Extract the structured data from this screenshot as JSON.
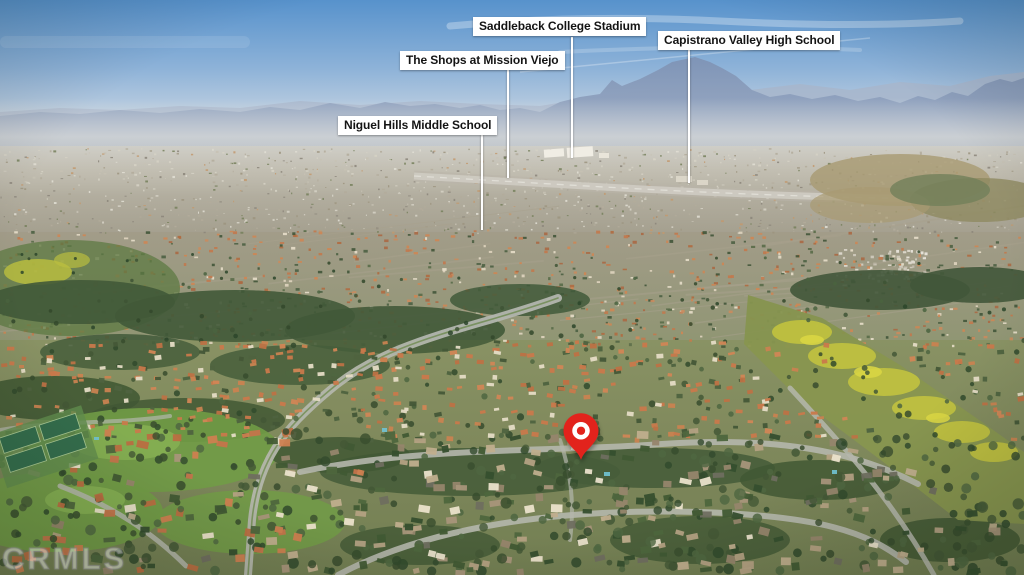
{
  "scene": {
    "type": "annotated aerial photograph",
    "description": "Aerial drone view over Spanish-tile-roof residential neighborhoods in a Southern California valley; hazy Saddleback mountain range on the horizon, a freeway corridor in the distance, greenbelts, a yellow wildflower hillside on the right and curving suburban streets in the foreground",
    "sky_color": "#5792cc",
    "mountain_color": "#7e93b5",
    "roof_color": "#c4714a",
    "greenbelt_color": "#415939"
  },
  "annotations": {
    "label_style": {
      "background": "#ffffff",
      "text_color": "#141414",
      "line_color": "#ffffff"
    },
    "labels": [
      {
        "id": "saddleback-college-stadium",
        "text": "Saddleback College Stadium"
      },
      {
        "id": "the-shops-at-mission-viejo",
        "text": "The Shops at Mission Viejo"
      },
      {
        "id": "capistrano-valley-high-school",
        "text": "Capistrano Valley High School"
      },
      {
        "id": "niguel-hills-middle-school",
        "text": "Niguel Hills Middle School"
      }
    ],
    "pin": {
      "name": "property-location-pin",
      "color": "#e2231c",
      "inner_color": "#ffffff"
    }
  },
  "watermark": {
    "text": "CRMLS"
  }
}
